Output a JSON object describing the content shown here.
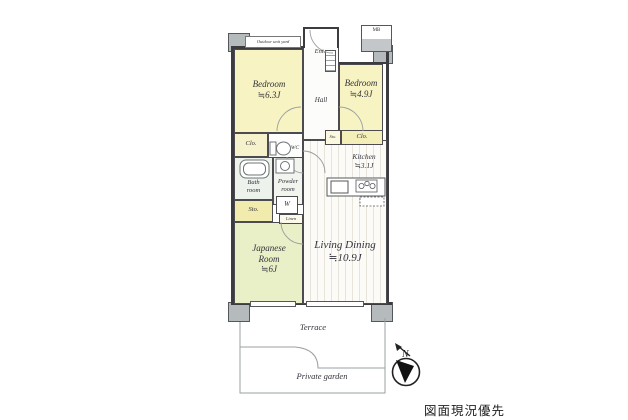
{
  "colors": {
    "room_yellow": "#f7f3c2",
    "closet_yellow": "#f2ecae",
    "room_green": "#e9efc6",
    "wall_dark": "#3c3c40",
    "pillar_gray": "#b5babc",
    "line_gray": "#9aa0a0"
  },
  "rooms": {
    "bedroom_left": {
      "name": "Bedroom",
      "size": "≒6.3J"
    },
    "bedroom_right": {
      "name": "Bedroom",
      "size": "≒4.9J"
    },
    "living_dining": {
      "name": "Living Dining",
      "size": "≒10.9J"
    },
    "japanese_room": {
      "name_line1": "Japanese",
      "name_line2": "Room",
      "size": "≒6J"
    },
    "kitchen": {
      "name": "Kitchen",
      "size": "≒3.1J"
    },
    "bath_room": {
      "name_line1": "Bath",
      "name_line2": "room"
    },
    "powder_room": {
      "name_line1": "Powder",
      "name_line2": "room"
    },
    "hall": {
      "name": "Hall"
    },
    "entrance": {
      "name": "Ent."
    },
    "wc": {
      "name": "WC"
    },
    "washer": {
      "name": "W"
    },
    "closet_hall": {
      "name": "Clo."
    },
    "closet_bedroom_right": {
      "name": "Clo."
    },
    "storage_bedroom_right": {
      "name": "Sto."
    },
    "storage_bath": {
      "name": "Sto."
    },
    "linen": {
      "name": "Linen"
    },
    "meter_box": {
      "name": "MB"
    },
    "outdoor_unit_yard": {
      "name": "Outdoor unit yard"
    }
  },
  "outdoor": {
    "terrace": "Terrace",
    "private_garden": "Private garden",
    "compass_north": "N"
  },
  "caption": "図面現況優先"
}
